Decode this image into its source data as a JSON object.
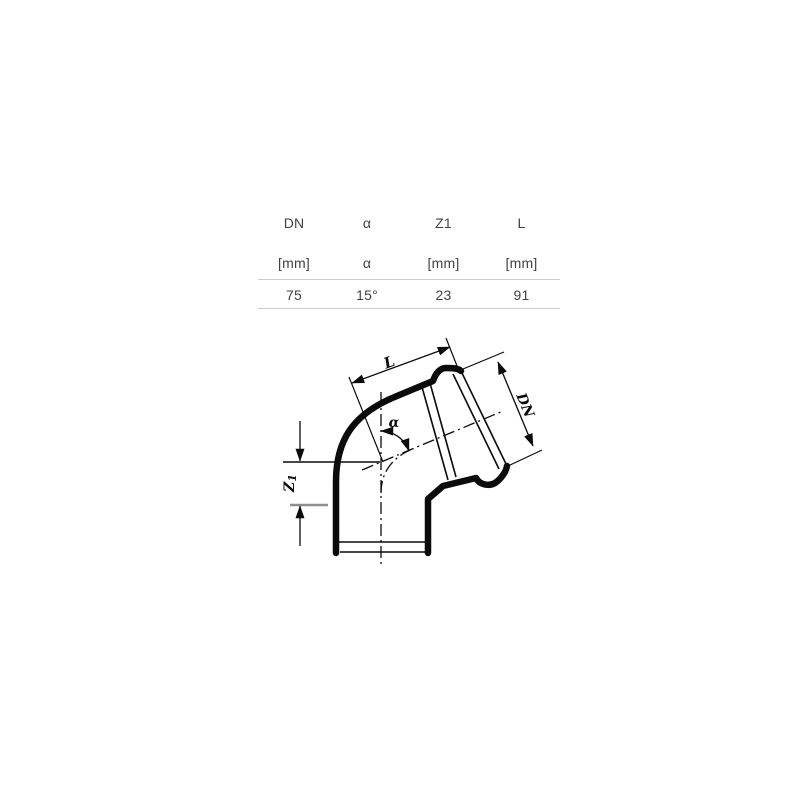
{
  "table": {
    "columns": [
      {
        "header": "DN",
        "unit": "[mm]",
        "value": "75"
      },
      {
        "header": "α",
        "unit": "α",
        "value": "15°"
      },
      {
        "header": "Z1",
        "unit": "[mm]",
        "value": "23"
      },
      {
        "header": "L",
        "unit": "[mm]",
        "value": "91"
      }
    ],
    "rule_color": "#cccccc",
    "text_color": "#414146"
  },
  "drawing": {
    "type": "technical-diagram",
    "subject": "socketed pipe elbow bend fitting",
    "labels": {
      "length": "L",
      "diameter": "DN",
      "offset_z": "Z",
      "offset_z_sub": "1",
      "angle": "α"
    },
    "stroke_color": "#0b0b0b",
    "ref_line_gray": "#8f8f8f"
  }
}
